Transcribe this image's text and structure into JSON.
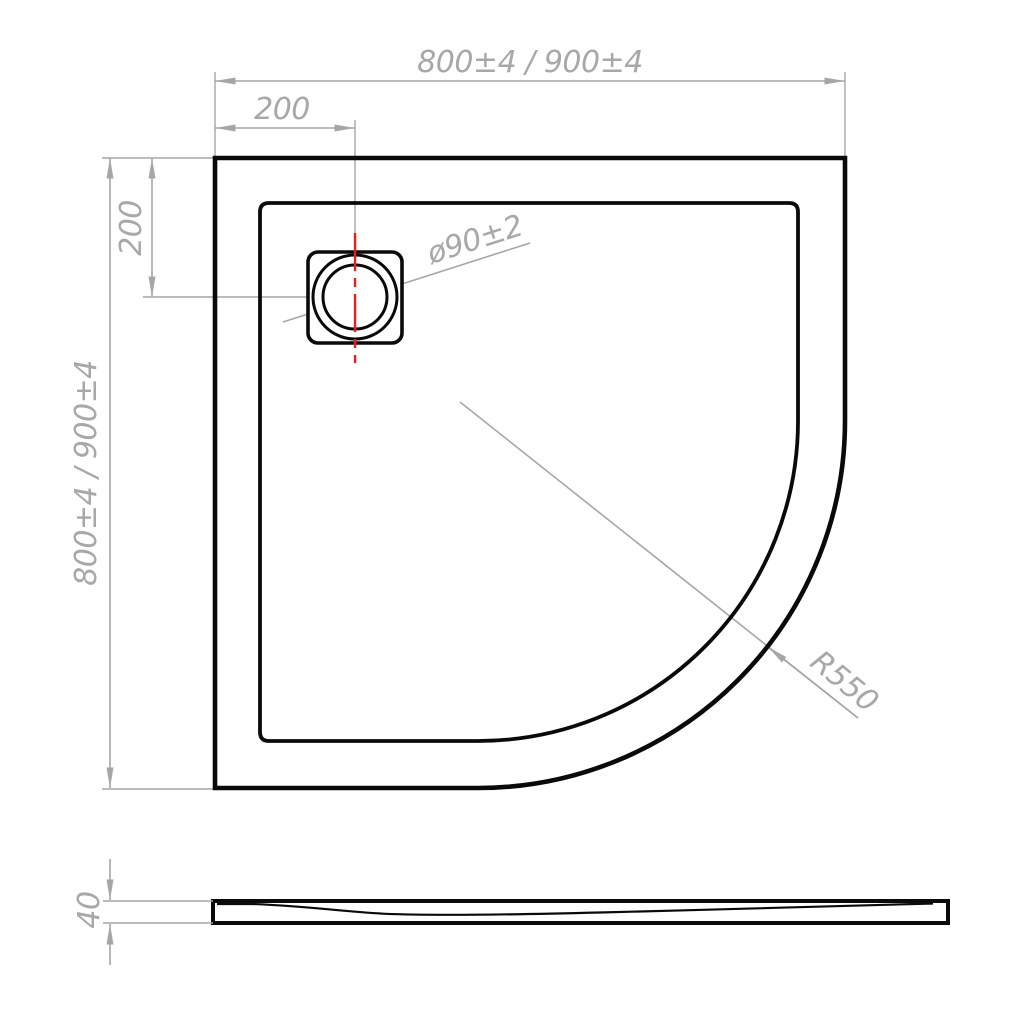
{
  "drawing": {
    "title": "Quadrant shower tray technical drawing",
    "colors": {
      "background": "#ffffff",
      "outline": "#0a0a0a",
      "dimension": "#a6a6a6",
      "dimension_text": "#a8a8a8",
      "centerline_red": "#ee1c1c"
    },
    "top_view": {
      "labels": {
        "width": "800±4 / 900±4",
        "height": "800±4 / 900±4",
        "drain_offset_top": "200",
        "drain_offset_side": "200",
        "drain_diameter": "ø90±2",
        "corner_radius": "R550"
      }
    },
    "side_view": {
      "labels": {
        "thickness": "40"
      }
    }
  }
}
